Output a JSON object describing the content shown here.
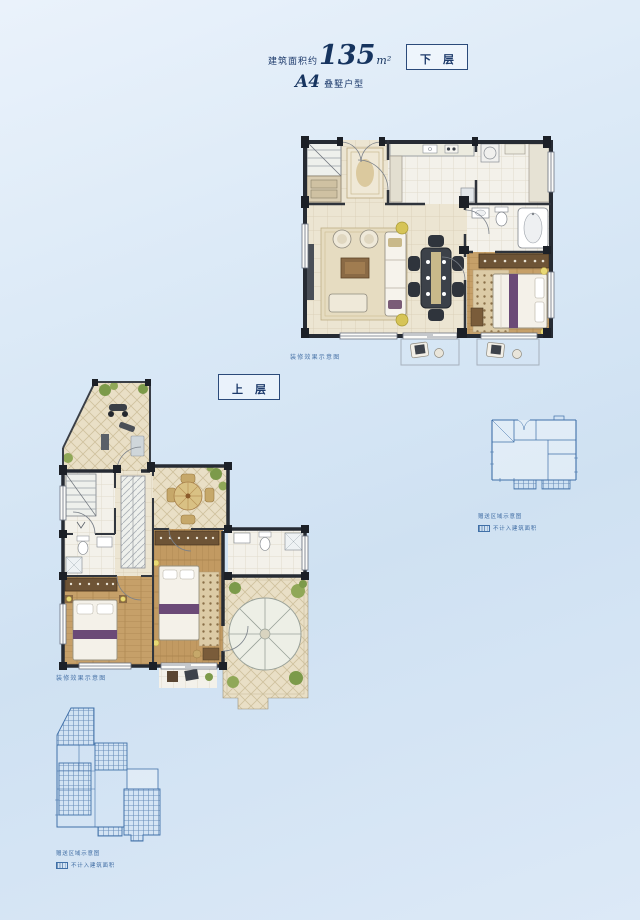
{
  "header": {
    "area_prefix": "建筑面积约",
    "area_value": "135",
    "area_unit": "m²",
    "unit_code": "A4",
    "unit_type": "叠墅户型"
  },
  "lower": {
    "label": "下层",
    "caption": "装修效果示意图"
  },
  "upper": {
    "label": "上层",
    "caption": "装修效果示意图"
  },
  "keyplan_lower": {
    "caption": "赠送区域示意图",
    "legend": "不计入建筑面积"
  },
  "keyplan_upper": {
    "caption": "赠送区域示意图",
    "legend": "不计入建筑面积"
  },
  "colors": {
    "background_top": "#eaf2fb",
    "background_bottom": "#cfe1f2",
    "navy_text": "#1d3a6b",
    "keyplan_blue": "#4070a8",
    "wall_dark": "#262b33",
    "floor_beige": "#ece5d2",
    "wood_floor": "#c29a62",
    "terrace_tile": "#e9dfc6",
    "accent_purple": "#6b4a77",
    "plant_green": "#7c9a4a"
  }
}
